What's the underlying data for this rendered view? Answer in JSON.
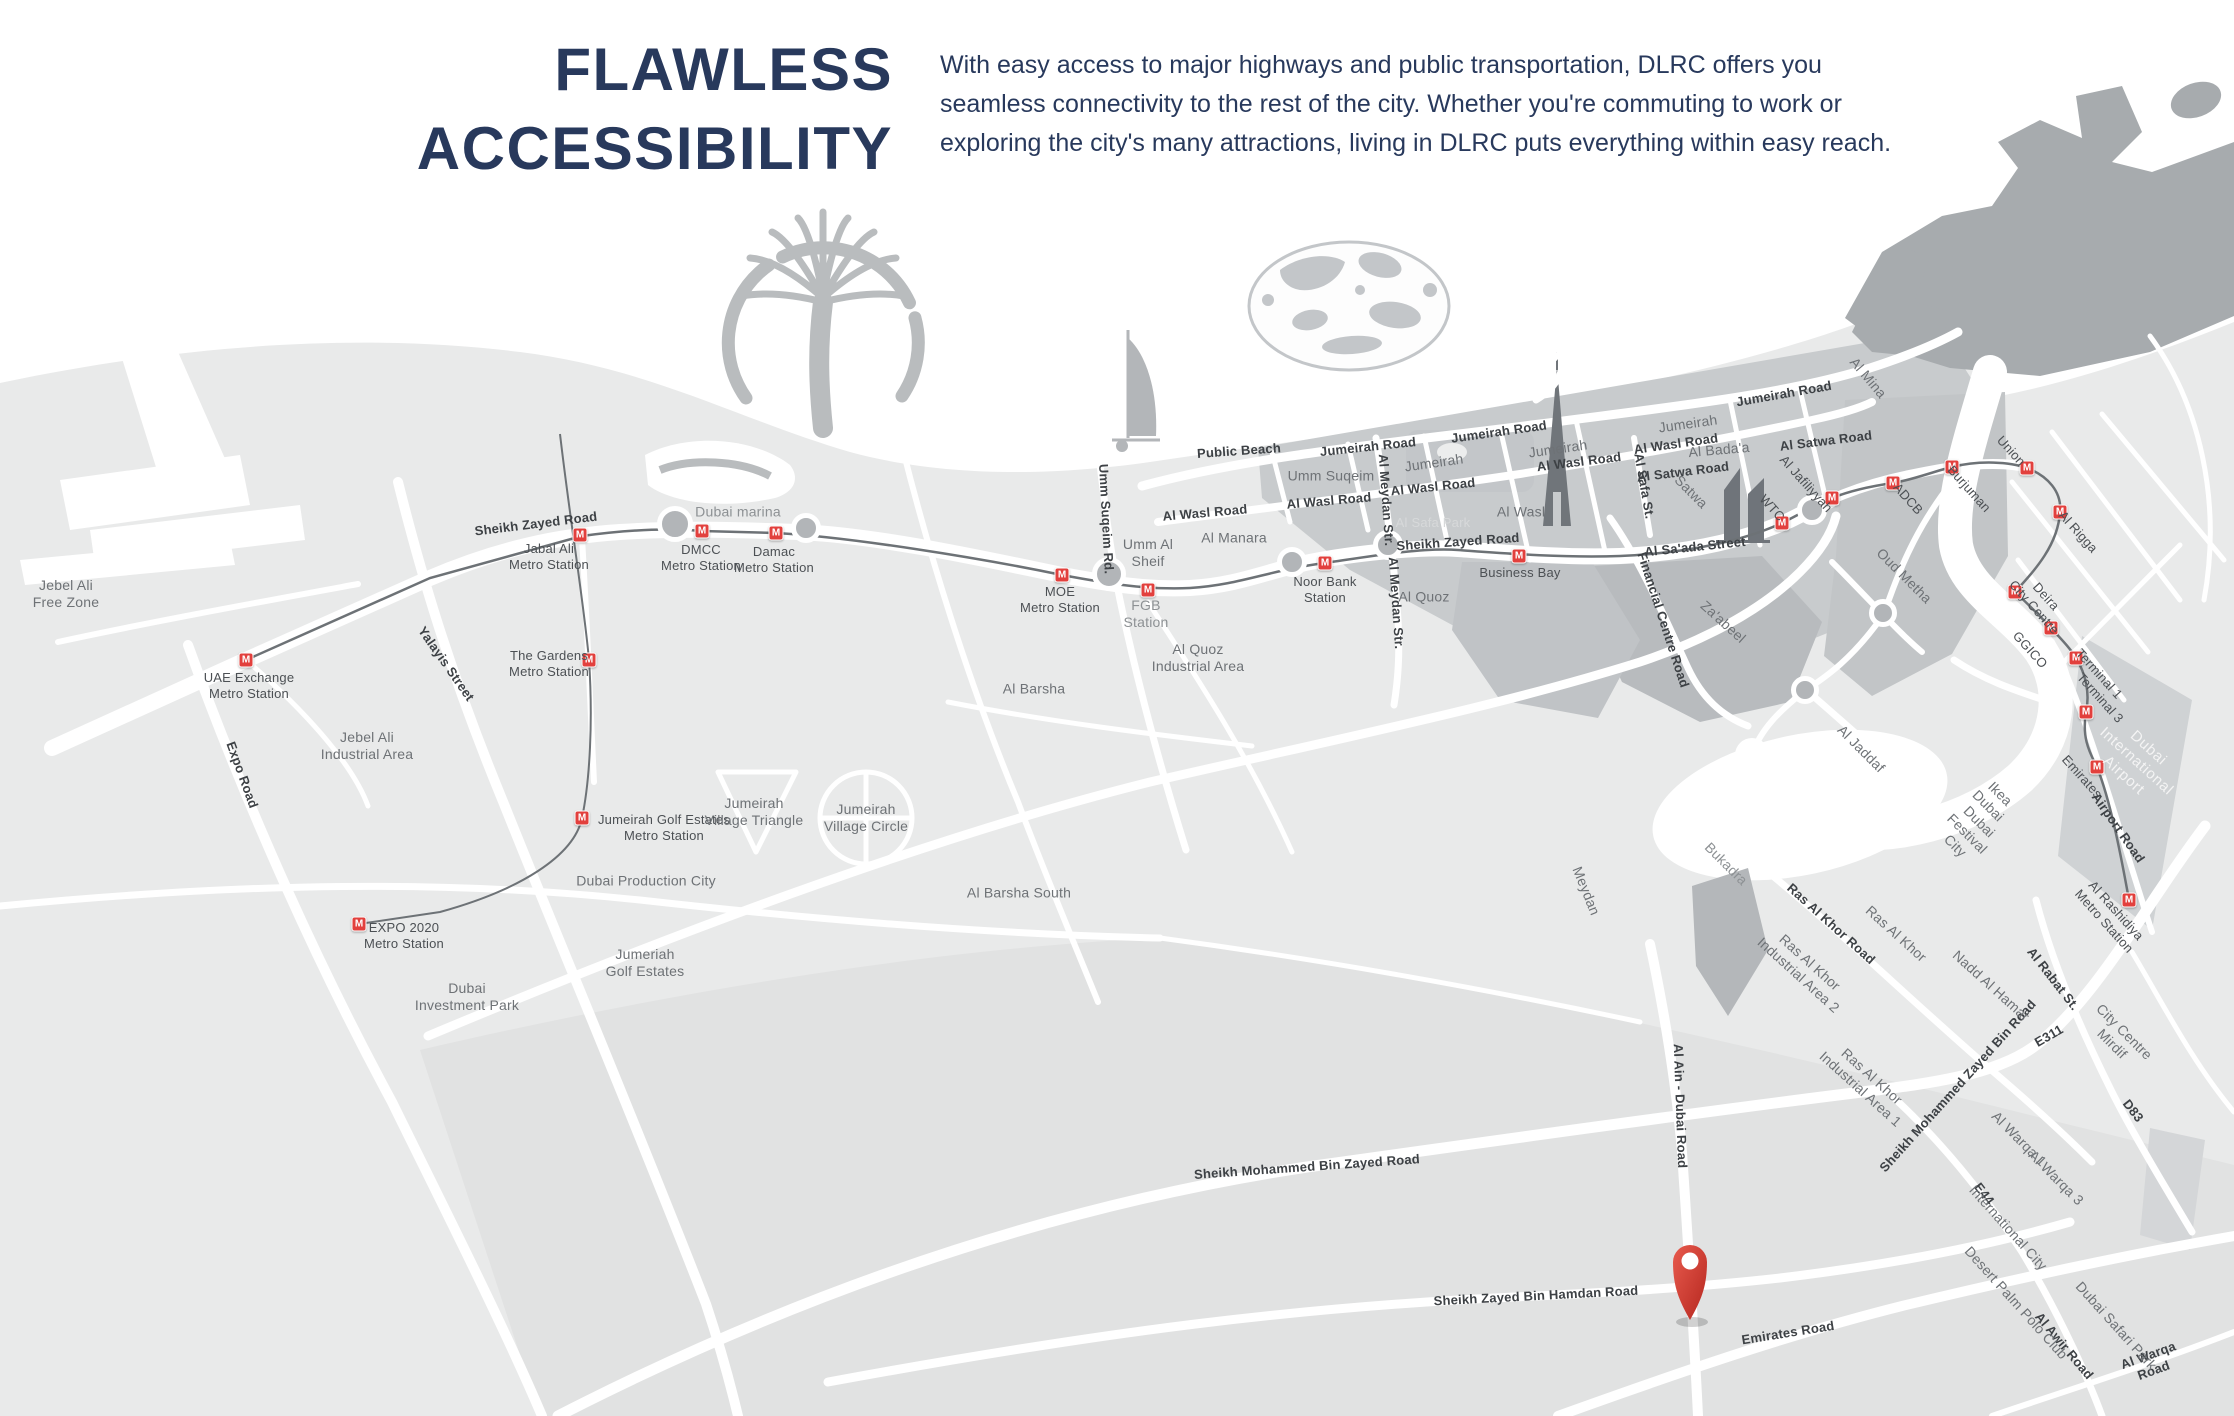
{
  "header": {
    "title": "FLAWLESS\nACCESSIBILITY",
    "description": "With easy access to major highways and public transportation, DLRC offers you seamless connectivity to the rest of the city. Whether you're commuting to work or exploring the city's many attractions, living in DLRC puts everything within easy reach.",
    "title_color": "#28395c"
  },
  "map": {
    "badge_letter": "M",
    "accent_red": "#e2403d",
    "pin_color": "#cf3a30",
    "stations": [
      {
        "x": 246,
        "y": 660
      },
      {
        "x": 580,
        "y": 535
      },
      {
        "x": 702,
        "y": 531
      },
      {
        "x": 776,
        "y": 533
      },
      {
        "x": 1062,
        "y": 575
      },
      {
        "x": 1148,
        "y": 590
      },
      {
        "x": 1325,
        "y": 563
      },
      {
        "x": 1519,
        "y": 556
      },
      {
        "x": 589,
        "y": 660
      },
      {
        "x": 582,
        "y": 818
      },
      {
        "x": 359,
        "y": 924
      },
      {
        "x": 1782,
        "y": 523
      },
      {
        "x": 1832,
        "y": 498
      },
      {
        "x": 1893,
        "y": 483
      },
      {
        "x": 1952,
        "y": 467
      },
      {
        "x": 2027,
        "y": 468
      },
      {
        "x": 2060,
        "y": 512
      },
      {
        "x": 2015,
        "y": 592
      },
      {
        "x": 2051,
        "y": 628
      },
      {
        "x": 2076,
        "y": 658
      },
      {
        "x": 2086,
        "y": 712
      },
      {
        "x": 2097,
        "y": 767
      },
      {
        "x": 2129,
        "y": 900
      }
    ],
    "roundabouts": [
      {
        "x": 675,
        "y": 524,
        "d": 36
      },
      {
        "x": 806,
        "y": 528,
        "d": 30
      },
      {
        "x": 1109,
        "y": 574,
        "d": 34
      },
      {
        "x": 1292,
        "y": 562,
        "d": 30
      },
      {
        "x": 1388,
        "y": 545,
        "d": 30
      },
      {
        "x": 1812,
        "y": 510,
        "d": 30
      },
      {
        "x": 1883,
        "y": 613,
        "d": 28
      },
      {
        "x": 1805,
        "y": 690,
        "d": 28
      }
    ],
    "labels": [
      {
        "t": "UAE Exchange\nMetro Station",
        "x": 249,
        "y": 686,
        "c": "station"
      },
      {
        "t": "Jabal Ali\nMetro Station",
        "x": 549,
        "y": 557,
        "c": "station"
      },
      {
        "t": "DMCC\nMetro Station",
        "x": 701,
        "y": 558,
        "c": "station"
      },
      {
        "t": "Damac\nMetro Station",
        "x": 774,
        "y": 560,
        "c": "station"
      },
      {
        "t": "MOE\nMetro Station",
        "x": 1060,
        "y": 600,
        "c": "station"
      },
      {
        "t": "FGB\nStation",
        "x": 1146,
        "y": 614,
        "c": "soft"
      },
      {
        "t": "Noor Bank\nStation",
        "x": 1325,
        "y": 590,
        "c": "station"
      },
      {
        "t": "Business Bay",
        "x": 1520,
        "y": 573,
        "c": "station"
      },
      {
        "t": "The Gardens\nMetro Station",
        "x": 549,
        "y": 664,
        "c": "station"
      },
      {
        "t": "Jumeirah Golf Estates\nMetro Station",
        "x": 664,
        "y": 828,
        "c": "station"
      },
      {
        "t": "EXPO 2020\nMetro Station",
        "x": 404,
        "y": 936,
        "c": "station"
      },
      {
        "t": "WTC",
        "x": 1772,
        "y": 508,
        "r": 48,
        "c": "station"
      },
      {
        "t": "Al Jafiliyyah",
        "x": 1806,
        "y": 484,
        "r": 48,
        "c": "station"
      },
      {
        "t": "ADCB",
        "x": 1908,
        "y": 499,
        "r": 48,
        "c": "station"
      },
      {
        "t": "Burjuman",
        "x": 1969,
        "y": 489,
        "r": 48,
        "c": "station"
      },
      {
        "t": "Union",
        "x": 2011,
        "y": 451,
        "r": 48,
        "c": "station"
      },
      {
        "t": "Al Rigga",
        "x": 2078,
        "y": 532,
        "r": 48,
        "c": "station"
      },
      {
        "t": "Deira\nCity Centre",
        "x": 2040,
        "y": 602,
        "r": 48,
        "c": "station"
      },
      {
        "t": "GGICO",
        "x": 2030,
        "y": 650,
        "r": 48,
        "c": "station"
      },
      {
        "t": "Terminal 1",
        "x": 2099,
        "y": 674,
        "r": 48,
        "c": "station"
      },
      {
        "t": "Terminal 3",
        "x": 2100,
        "y": 698,
        "r": 48,
        "c": "station"
      },
      {
        "t": "Emirates",
        "x": 2082,
        "y": 777,
        "r": 48,
        "c": "station"
      },
      {
        "t": "Al Rashidiya\nMetro Station",
        "x": 2110,
        "y": 916,
        "r": 48,
        "c": "station"
      },
      {
        "t": "Sheikh Zayed Road",
        "x": 536,
        "y": 524,
        "r": -7,
        "c": "road"
      },
      {
        "t": "Sheikh Zayed Road",
        "x": 1458,
        "y": 542,
        "r": -4,
        "c": "road"
      },
      {
        "t": "Public Beach",
        "x": 1239,
        "y": 451,
        "r": -4,
        "c": "road"
      },
      {
        "t": "Jumeirah Road",
        "x": 1368,
        "y": 447,
        "r": -6,
        "c": "road"
      },
      {
        "t": "Jumeirah Road",
        "x": 1499,
        "y": 432,
        "r": -8,
        "c": "road"
      },
      {
        "t": "Jumeirah Road",
        "x": 1784,
        "y": 394,
        "r": -10,
        "c": "road"
      },
      {
        "t": "Al Wasl Road",
        "x": 1205,
        "y": 513,
        "r": -5,
        "c": "road"
      },
      {
        "t": "Al Wasl Road",
        "x": 1329,
        "y": 501,
        "r": -5,
        "c": "road"
      },
      {
        "t": "Al Wasl Road",
        "x": 1433,
        "y": 487,
        "r": -6,
        "c": "road"
      },
      {
        "t": "Al Wasl Road",
        "x": 1579,
        "y": 462,
        "r": -7,
        "c": "road"
      },
      {
        "t": "Al Wasl Road",
        "x": 1676,
        "y": 444,
        "r": -8,
        "c": "road"
      },
      {
        "t": "Al Satwa Road",
        "x": 1683,
        "y": 472,
        "r": -7,
        "c": "road"
      },
      {
        "t": "Al Satwa Road",
        "x": 1826,
        "y": 441,
        "r": -7,
        "c": "road"
      },
      {
        "t": "Al Sa'ada Street",
        "x": 1695,
        "y": 547,
        "r": -6,
        "c": "road"
      },
      {
        "t": "Umm Suqeim Rd.",
        "x": 1106,
        "y": 519,
        "r": 87,
        "c": "road"
      },
      {
        "t": "Al Meydan Str.",
        "x": 1386,
        "y": 500,
        "r": 86,
        "c": "road"
      },
      {
        "t": "Al Meydan Str.",
        "x": 1396,
        "y": 603,
        "r": 86,
        "c": "road"
      },
      {
        "t": "Al Safa St.",
        "x": 1644,
        "y": 486,
        "r": 80,
        "c": "road"
      },
      {
        "t": "Financial Centre Road",
        "x": 1663,
        "y": 620,
        "r": 72,
        "c": "road"
      },
      {
        "t": "Expo Road",
        "x": 242,
        "y": 775,
        "r": 70,
        "c": "road"
      },
      {
        "t": "Yalayis Street",
        "x": 446,
        "y": 664,
        "r": 55,
        "c": "road"
      },
      {
        "t": "Airport Road",
        "x": 2118,
        "y": 828,
        "r": 55,
        "c": "road"
      },
      {
        "t": "Ras Al Khor Road",
        "x": 1831,
        "y": 924,
        "r": 42,
        "c": "road"
      },
      {
        "t": "Al Rabat St.",
        "x": 2053,
        "y": 979,
        "r": 52,
        "c": "road"
      },
      {
        "t": "E311",
        "x": 2049,
        "y": 1036,
        "r": -30,
        "c": "road"
      },
      {
        "t": "D83",
        "x": 2133,
        "y": 1111,
        "r": 52,
        "c": "road"
      },
      {
        "t": "E44",
        "x": 1984,
        "y": 1194,
        "r": 52,
        "c": "road"
      },
      {
        "t": "Al Awir Road",
        "x": 2064,
        "y": 1346,
        "r": 50,
        "c": "road"
      },
      {
        "t": "Al Warqa Road",
        "x": 2151,
        "y": 1363,
        "r": -20,
        "c": "road"
      },
      {
        "t": "Sheikh Mohammed Zayed Bin Road",
        "x": 1958,
        "y": 1086,
        "r": -48,
        "c": "road"
      },
      {
        "t": "Sheikh Mohammed Bin Zayed Road",
        "x": 1307,
        "y": 1167,
        "r": -4,
        "c": "road"
      },
      {
        "t": "Sheikh Zayed Bin Hamdan Road",
        "x": 1536,
        "y": 1296,
        "r": -3,
        "c": "road"
      },
      {
        "t": "Emirates Road",
        "x": 1788,
        "y": 1333,
        "r": -9,
        "c": "road"
      },
      {
        "t": "Al Ain - Dubai Road",
        "x": 1680,
        "y": 1106,
        "r": 88,
        "c": "road"
      },
      {
        "t": "Jebel Ali\nFree Zone",
        "x": 66,
        "y": 594,
        "c": "area"
      },
      {
        "t": "Jebel Ali\nIndustrial Area",
        "x": 367,
        "y": 746,
        "c": "area"
      },
      {
        "t": "Dubai\nInvestment Park",
        "x": 467,
        "y": 997,
        "c": "area"
      },
      {
        "t": "Dubai Production City",
        "x": 646,
        "y": 881,
        "c": "area"
      },
      {
        "t": "Jumeriah\nGolf Estates",
        "x": 645,
        "y": 963,
        "c": "area"
      },
      {
        "t": "Jumeirah\nVillage Triangle",
        "x": 754,
        "y": 812,
        "c": "area"
      },
      {
        "t": "Jumeirah\nVillage Circle",
        "x": 866,
        "y": 818,
        "c": "area"
      },
      {
        "t": "Al Barsha",
        "x": 1034,
        "y": 689,
        "c": "area"
      },
      {
        "t": "Al Barsha South",
        "x": 1019,
        "y": 893,
        "c": "area"
      },
      {
        "t": "Al Quoz\nIndustrial Area",
        "x": 1198,
        "y": 658,
        "c": "area"
      },
      {
        "t": "Al Quoz",
        "x": 1424,
        "y": 597,
        "c": "area"
      },
      {
        "t": "Umm Al\nSheif",
        "x": 1148,
        "y": 553,
        "c": "area"
      },
      {
        "t": "Al Manara",
        "x": 1234,
        "y": 538,
        "c": "area"
      },
      {
        "t": "Umm Suqeim",
        "x": 1331,
        "y": 476,
        "c": "area"
      },
      {
        "t": "Jumeirah",
        "x": 1434,
        "y": 463,
        "r": -8,
        "c": "area"
      },
      {
        "t": "Jumeirah",
        "x": 1558,
        "y": 449,
        "r": -8,
        "c": "area"
      },
      {
        "t": "Jumeirah",
        "x": 1688,
        "y": 424,
        "r": -8,
        "c": "area"
      },
      {
        "t": "Al Bada'a",
        "x": 1719,
        "y": 450,
        "r": -5,
        "c": "area"
      },
      {
        "t": "Satwa",
        "x": 1691,
        "y": 492,
        "r": 45,
        "c": "area"
      },
      {
        "t": "Al Wasl",
        "x": 1521,
        "y": 512,
        "c": "area"
      },
      {
        "t": "Al Mina",
        "x": 1868,
        "y": 378,
        "r": 50,
        "c": "area"
      },
      {
        "t": "Dubai marina",
        "x": 738,
        "y": 512,
        "c": "soft"
      },
      {
        "t": "Za'abeel",
        "x": 1723,
        "y": 622,
        "r": 42,
        "c": "area"
      },
      {
        "t": "Oud Metha",
        "x": 1904,
        "y": 576,
        "r": 45,
        "c": "area"
      },
      {
        "t": "Al Jaddaf",
        "x": 1861,
        "y": 749,
        "r": 45,
        "c": "area"
      },
      {
        "t": "Meydan",
        "x": 1586,
        "y": 891,
        "r": 68,
        "c": "area"
      },
      {
        "t": "Bukadra",
        "x": 1726,
        "y": 864,
        "r": 45,
        "c": "soft"
      },
      {
        "t": "Ikea\nDubai",
        "x": 1994,
        "y": 800,
        "r": 45,
        "c": "area"
      },
      {
        "t": "Dubai\nFestival\nCity",
        "x": 1967,
        "y": 834,
        "r": 45,
        "c": "area"
      },
      {
        "t": "Ras Al Khor",
        "x": 1896,
        "y": 934,
        "r": 42,
        "c": "area"
      },
      {
        "t": "Ras Al Khor\nIndustrial Area 2",
        "x": 1804,
        "y": 969,
        "r": 42,
        "c": "area"
      },
      {
        "t": "Ras Al Khor\nIndustrial Area 1",
        "x": 1866,
        "y": 1083,
        "r": 42,
        "c": "area"
      },
      {
        "t": "Nadd Al Hamar",
        "x": 1991,
        "y": 986,
        "r": 42,
        "c": "area"
      },
      {
        "t": "City Centre\nMirdif",
        "x": 2118,
        "y": 1038,
        "r": 45,
        "c": "area"
      },
      {
        "t": "Al Warqa 1",
        "x": 2019,
        "y": 1139,
        "r": 45,
        "c": "area"
      },
      {
        "t": "Al Warqa 3",
        "x": 2056,
        "y": 1178,
        "r": 45,
        "c": "area"
      },
      {
        "t": "International City",
        "x": 2008,
        "y": 1228,
        "r": 48,
        "c": "area"
      },
      {
        "t": "Desert Palm Polo Club",
        "x": 2016,
        "y": 1303,
        "r": 48,
        "c": "area"
      },
      {
        "t": "Dubai Safari Park",
        "x": 2116,
        "y": 1326,
        "r": 48,
        "c": "area"
      },
      {
        "t": "Al Safa Park",
        "x": 1433,
        "y": 523,
        "c": "park"
      },
      {
        "t": "Dubai International\nAirport",
        "x": 2136,
        "y": 762,
        "r": 42,
        "c": "white"
      }
    ]
  }
}
